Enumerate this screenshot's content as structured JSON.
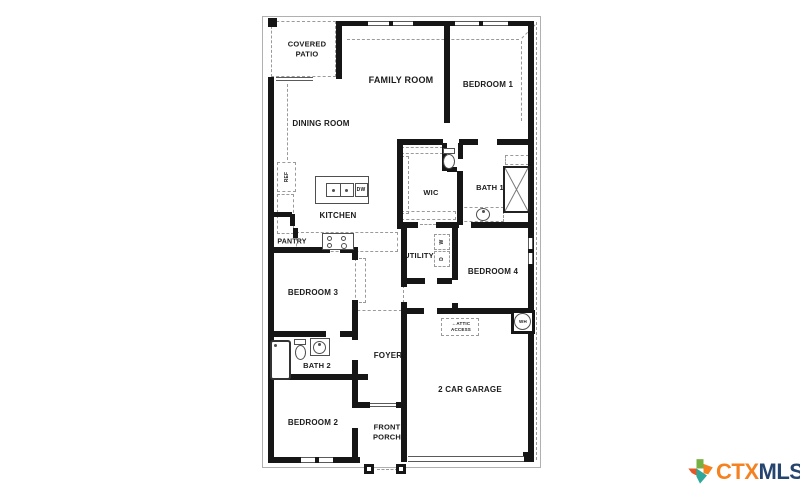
{
  "plan": {
    "rooms": {
      "covered_patio_line1": "COVERED",
      "covered_patio_line2": "PATIO",
      "family_room": "FAMILY ROOM",
      "bedroom_1": "BEDROOM 1",
      "dining_room": "DINING ROOM",
      "kitchen": "KITCHEN",
      "wic": "WIC",
      "bath_1": "BATH 1",
      "pantry": "PANTRY",
      "utility": "UTILITY",
      "bedroom_4": "BEDROOM 4",
      "bedroom_3": "BEDROOM 3",
      "bath_2": "BATH 2",
      "foyer": "FOYER",
      "bedroom_2": "BEDROOM 2",
      "front_porch_line1": "FRONT",
      "front_porch_line2": "PORCH",
      "garage": "2 CAR GARAGE"
    },
    "fixtures": {
      "refrigerator": "REF",
      "dishwasher": "DW",
      "washer": "W",
      "dryer": "D",
      "water_heater": "WH",
      "attic_line1": "ATTIC",
      "attic_line2": "ACCESS",
      "attic_arrow_icon": "←"
    },
    "colors": {
      "wall": "#161616",
      "dashed_line": "#9a9a9a",
      "label_text": "#1b1b1b"
    }
  },
  "branding": {
    "logo_ctx": "CTX",
    "logo_mls": "MLS",
    "ctx_color": "#F58220",
    "mls_color": "#25456F",
    "texas_green": "#76B043",
    "texas_orange": "#F58220",
    "texas_red": "#E15829",
    "texas_teal": "#2FA79B"
  }
}
